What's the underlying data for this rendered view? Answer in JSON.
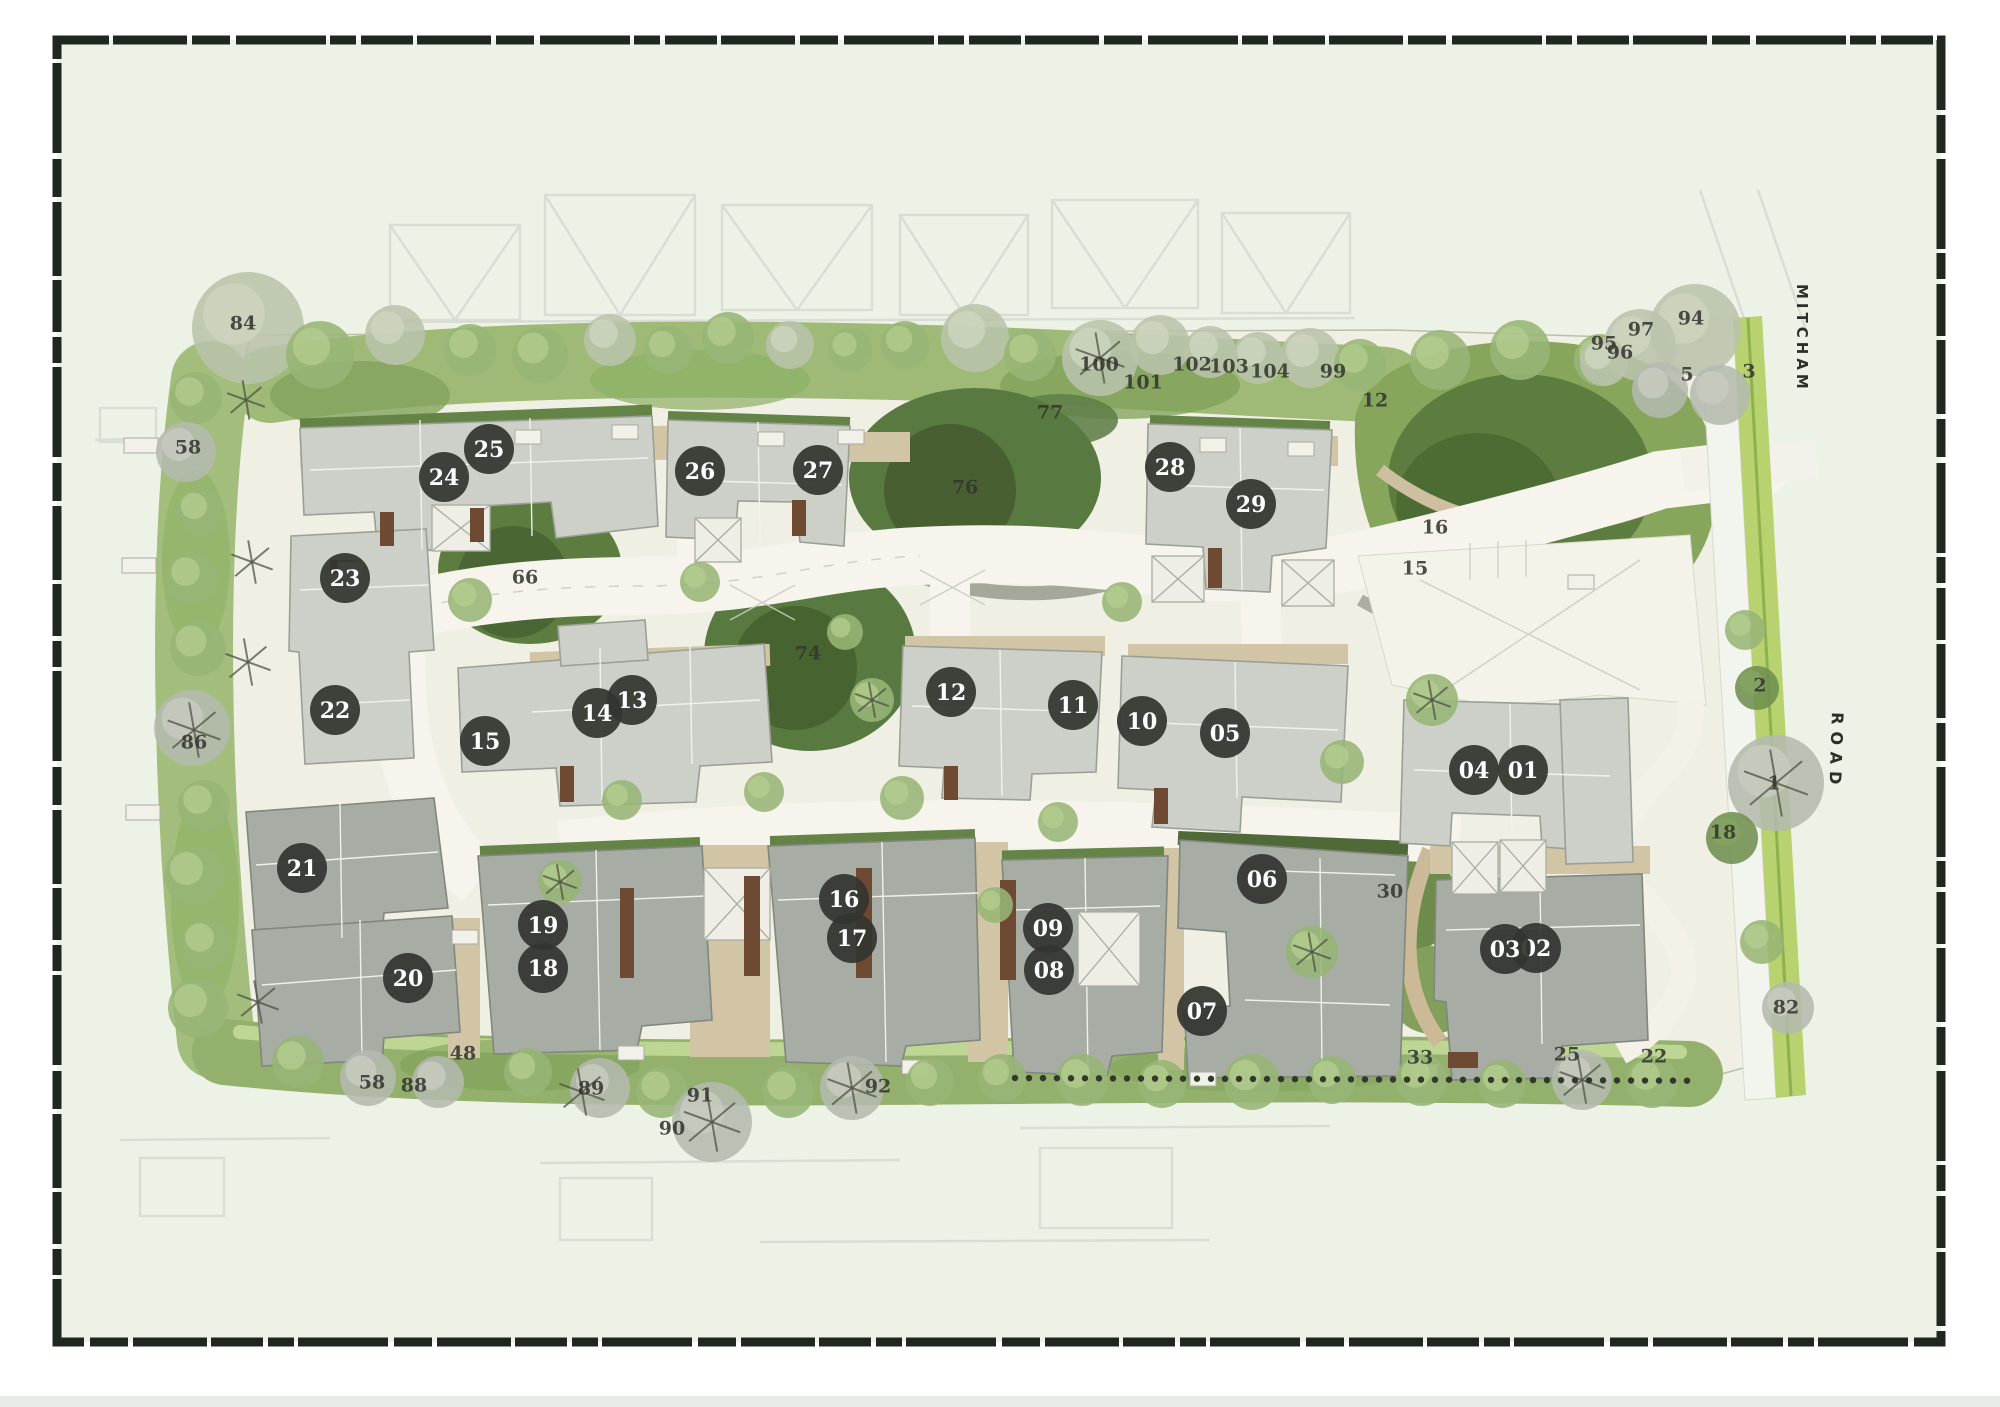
{
  "title": "residential development site plan",
  "roads": {
    "main_road_name_top": "MITCHAM",
    "main_road_name_bottom": "ROAD"
  },
  "colors": {
    "frame_border": "#20271e",
    "plan_background": "#ecf3e6",
    "page_background": "#ffffff",
    "bottom_strip": "#e8ebe8",
    "badge_fill": "#33352f",
    "badge_text": "#ffffff",
    "label_text": "#343730",
    "building_north": "#ccd0c9",
    "building_south": "#a7aca4",
    "green_dark": "#5c7c40",
    "green_band": "#9fba77",
    "road_verge": "#b7d26e",
    "paving": "#f0efe4",
    "tan": "#d2c5a5"
  },
  "plot_badges": [
    {
      "label": "01",
      "x": 1523,
      "y": 770
    },
    {
      "label": "02",
      "x": 1536,
      "y": 948
    },
    {
      "label": "03",
      "x": 1505,
      "y": 949
    },
    {
      "label": "04",
      "x": 1474,
      "y": 770
    },
    {
      "label": "05",
      "x": 1225,
      "y": 733
    },
    {
      "label": "06",
      "x": 1262,
      "y": 879
    },
    {
      "label": "07",
      "x": 1202,
      "y": 1011
    },
    {
      "label": "08",
      "x": 1049,
      "y": 970
    },
    {
      "label": "09",
      "x": 1048,
      "y": 928
    },
    {
      "label": "10",
      "x": 1142,
      "y": 721
    },
    {
      "label": "11",
      "x": 1073,
      "y": 705
    },
    {
      "label": "12",
      "x": 951,
      "y": 692
    },
    {
      "label": "13",
      "x": 632,
      "y": 700
    },
    {
      "label": "14",
      "x": 597,
      "y": 713
    },
    {
      "label": "15",
      "x": 485,
      "y": 741
    },
    {
      "label": "16",
      "x": 844,
      "y": 899
    },
    {
      "label": "17",
      "x": 852,
      "y": 938
    },
    {
      "label": "18",
      "x": 543,
      "y": 968
    },
    {
      "label": "19",
      "x": 543,
      "y": 925
    },
    {
      "label": "20",
      "x": 408,
      "y": 978
    },
    {
      "label": "21",
      "x": 302,
      "y": 868
    },
    {
      "label": "22",
      "x": 335,
      "y": 710
    },
    {
      "label": "23",
      "x": 345,
      "y": 578
    },
    {
      "label": "24",
      "x": 444,
      "y": 477
    },
    {
      "label": "25",
      "x": 489,
      "y": 449
    },
    {
      "label": "26",
      "x": 700,
      "y": 471
    },
    {
      "label": "27",
      "x": 818,
      "y": 470
    },
    {
      "label": "28",
      "x": 1170,
      "y": 467
    },
    {
      "label": "29",
      "x": 1251,
      "y": 504
    }
  ],
  "landscape_labels": [
    {
      "text": "84",
      "x": 243,
      "y": 323
    },
    {
      "text": "58",
      "x": 188,
      "y": 447
    },
    {
      "text": "86",
      "x": 194,
      "y": 742
    },
    {
      "text": "58",
      "x": 372,
      "y": 1082
    },
    {
      "text": "88",
      "x": 414,
      "y": 1085
    },
    {
      "text": "48",
      "x": 463,
      "y": 1053
    },
    {
      "text": "89",
      "x": 591,
      "y": 1088
    },
    {
      "text": "91",
      "x": 700,
      "y": 1095
    },
    {
      "text": "90",
      "x": 672,
      "y": 1128
    },
    {
      "text": "92",
      "x": 878,
      "y": 1086
    },
    {
      "text": "100",
      "x": 1099,
      "y": 364
    },
    {
      "text": "101",
      "x": 1143,
      "y": 382
    },
    {
      "text": "102",
      "x": 1192,
      "y": 364
    },
    {
      "text": "103",
      "x": 1229,
      "y": 366
    },
    {
      "text": "104",
      "x": 1270,
      "y": 371
    },
    {
      "text": "99",
      "x": 1333,
      "y": 371
    },
    {
      "text": "12",
      "x": 1375,
      "y": 400
    },
    {
      "text": "97",
      "x": 1641,
      "y": 329
    },
    {
      "text": "94",
      "x": 1691,
      "y": 318
    },
    {
      "text": "95",
      "x": 1604,
      "y": 343
    },
    {
      "text": "96",
      "x": 1620,
      "y": 352
    },
    {
      "text": "5",
      "x": 1687,
      "y": 374
    },
    {
      "text": "3",
      "x": 1749,
      "y": 371
    },
    {
      "text": "77",
      "x": 1050,
      "y": 412
    },
    {
      "text": "76",
      "x": 965,
      "y": 487
    },
    {
      "text": "66",
      "x": 525,
      "y": 577
    },
    {
      "text": "74",
      "x": 808,
      "y": 653
    },
    {
      "text": "16",
      "x": 1435,
      "y": 527
    },
    {
      "text": "15",
      "x": 1415,
      "y": 568
    },
    {
      "text": "2",
      "x": 1760,
      "y": 685
    },
    {
      "text": "1",
      "x": 1774,
      "y": 783
    },
    {
      "text": "18",
      "x": 1723,
      "y": 832
    },
    {
      "text": "82",
      "x": 1786,
      "y": 1007
    },
    {
      "text": "30",
      "x": 1390,
      "y": 891
    },
    {
      "text": "33",
      "x": 1420,
      "y": 1057
    },
    {
      "text": "25",
      "x": 1567,
      "y": 1054
    },
    {
      "text": "22",
      "x": 1654,
      "y": 1056
    }
  ]
}
